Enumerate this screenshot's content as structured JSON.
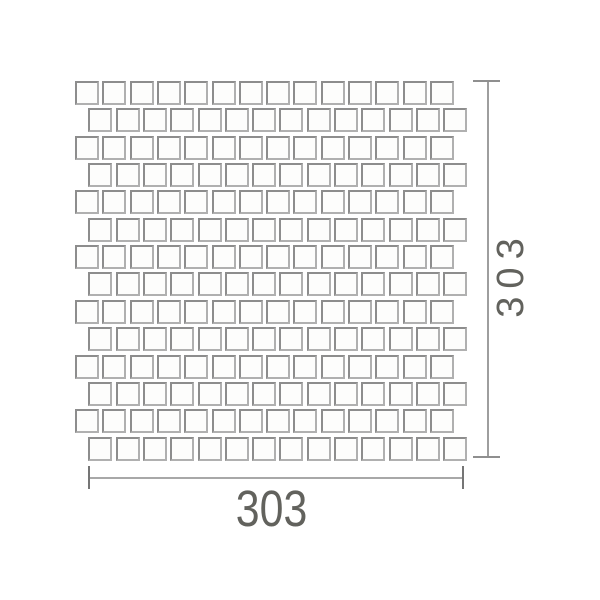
{
  "drawing": {
    "kind": "mosaic-tile-sheet-dimension-drawing",
    "background": "#ffffff",
    "sheet": {
      "rows": 14,
      "columns": 14,
      "tile_size_px": 24,
      "pitch_x": 27.3,
      "pitch_y": 27.35,
      "origin_x": 75,
      "origin_y": 81,
      "even_row_offset_x": 13.3,
      "tile_fill": "#fdfdfc",
      "tile_border_color": "#9a9a9a"
    },
    "dimensions": {
      "width_label": "303",
      "height_label": "303",
      "line_color": "#9e9e9e",
      "tick_color": "#757575",
      "text_color": "#62625d"
    }
  }
}
